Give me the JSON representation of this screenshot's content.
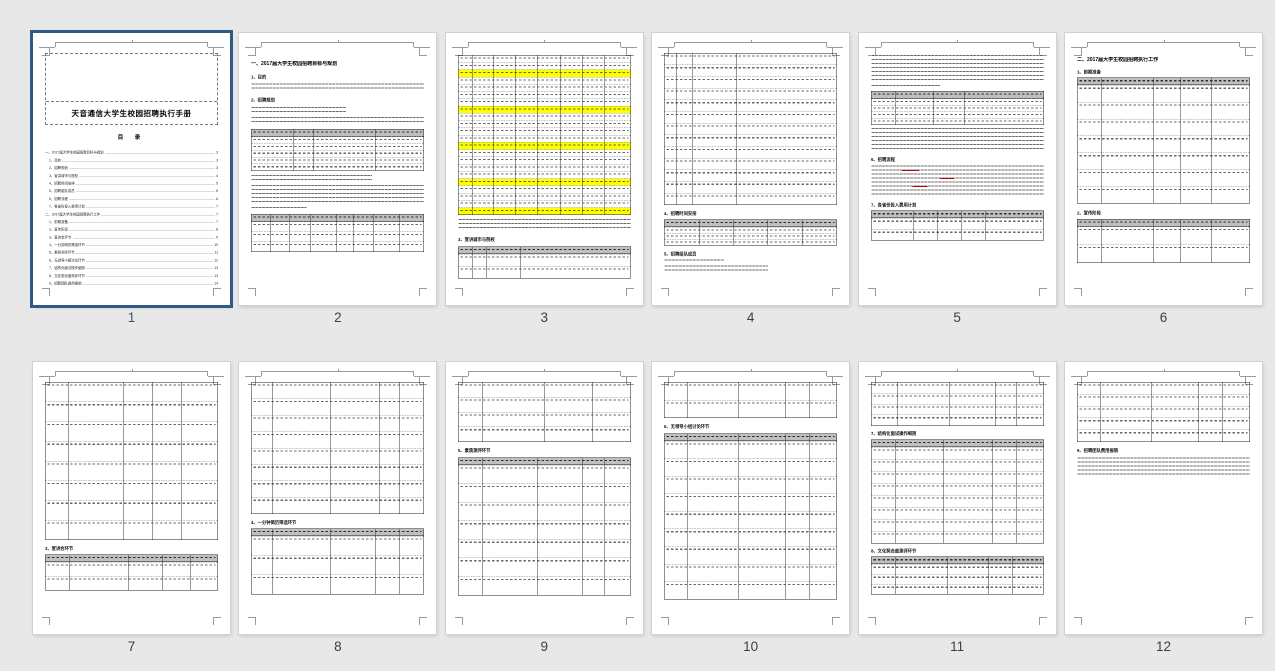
{
  "app": {
    "view": "document-thumbnail-grid",
    "background": "#e8e8e8",
    "selection_color": "#2e5a87",
    "page_number_color": "#3e3e3e",
    "selected_page_number_color": "#35587c",
    "table_header_gray": "#bfbfbf",
    "highlight_yellow": "#ffff00",
    "selected_page": "1",
    "page_count": "12"
  },
  "document": {
    "title": "天音通信大学生校园招聘执行手册",
    "toc_title": "目  录",
    "toc": [
      {
        "label": "一、2017届大学生校园招聘目标与规划",
        "page": "3",
        "indent": 0
      },
      {
        "label": "1、目的",
        "page": "3",
        "indent": 1
      },
      {
        "label": "2、招聘规划",
        "page": "3",
        "indent": 1
      },
      {
        "label": "3、宣讲城市与院校",
        "page": "4",
        "indent": 1
      },
      {
        "label": "4、招聘时间安排",
        "page": "5",
        "indent": 1
      },
      {
        "label": "5、招聘组队成员",
        "page": "5",
        "indent": 1
      },
      {
        "label": "6、招聘流程",
        "page": "6",
        "indent": 1
      },
      {
        "label": "7、各省份投入费用计划",
        "page": "7",
        "indent": 1
      },
      {
        "label": "二、2017届大学生校园招聘执行工作",
        "page": "7",
        "indent": 0
      },
      {
        "label": "1、前期准备",
        "page": "7",
        "indent": 1
      },
      {
        "label": "2、宣传阶段",
        "page": "8",
        "indent": 1
      },
      {
        "label": "3、宣讲会环节",
        "page": "9",
        "indent": 1
      },
      {
        "label": "4、一分钟简历筛选环节",
        "page": "10",
        "indent": 1
      },
      {
        "label": "5、素质测评环节",
        "page": "11",
        "indent": 1
      },
      {
        "label": "6、无领导小组讨论环节",
        "page": "12",
        "indent": 1
      },
      {
        "label": "7、结构化面试操作细则",
        "page": "13",
        "indent": 1
      },
      {
        "label": "8、文化契合度测评环节",
        "page": "13",
        "indent": 1
      },
      {
        "label": "9、招聘团队费用报销",
        "page": "14",
        "indent": 1
      }
    ]
  },
  "pages": [
    {
      "number": "1",
      "selected": true,
      "blocks": [
        {
          "t": "titlebox",
          "mt": 0,
          "h": 72
        },
        {
          "t": "toctitle",
          "mt": 8
        },
        {
          "t": "toc",
          "mt": 6
        }
      ]
    },
    {
      "number": "2",
      "selected": false,
      "blocks": [
        {
          "t": "h1",
          "text": "一、2017届大学生校园招聘目标与规划",
          "mt": 8
        },
        {
          "t": "h2",
          "text": "1、目的",
          "mt": 7
        },
        {
          "t": "para",
          "lines": 2,
          "mt": 4
        },
        {
          "t": "h2",
          "text": "2、招聘规划",
          "mt": 6
        },
        {
          "t": "para",
          "lines": 2,
          "mt": 4,
          "w": 55
        },
        {
          "t": "para",
          "lines": 2,
          "mt": 2
        },
        {
          "t": "table",
          "mt": 4,
          "h": 42,
          "cols": 4,
          "header": true,
          "rows": 5,
          "widths": [
            24,
            12,
            36,
            28
          ]
        },
        {
          "t": "para",
          "lines": 2,
          "mt": 4,
          "w": 70
        },
        {
          "t": "para",
          "lines": 5,
          "mt": 2
        },
        {
          "t": "para",
          "lines": 1,
          "mt": 2,
          "w": 32
        },
        {
          "t": "table",
          "mt": 3,
          "h": 38,
          "cols": 8,
          "header": true,
          "rows": 3,
          "widths": [
            11,
            11,
            12,
            15,
            10,
            12,
            15,
            14
          ]
        }
      ]
    },
    {
      "number": "3",
      "selected": false,
      "blocks": [
        {
          "t": "table",
          "mt": 2,
          "h": 160,
          "cols": 8,
          "rows": 22,
          "yellow": [
            2,
            7,
            12,
            17,
            21
          ],
          "widths": [
            8,
            12,
            13,
            13,
            13,
            13,
            13,
            15
          ]
        },
        {
          "t": "para",
          "lines": 3,
          "mt": 4
        },
        {
          "t": "h2",
          "text": "3、宣讲城市与院校",
          "mt": 6
        },
        {
          "t": "table",
          "mt": 4,
          "h": 32,
          "cols": 4,
          "header": true,
          "rows": 2,
          "widths": [
            8,
            8,
            20,
            64
          ]
        }
      ]
    },
    {
      "number": "4",
      "selected": false,
      "blocks": [
        {
          "t": "table",
          "mt": 0,
          "h": 152,
          "cols": 4,
          "rows": 13,
          "widths": [
            7,
            9,
            26,
            58
          ]
        },
        {
          "t": "h2",
          "text": "4、招聘时间安排",
          "mt": 6
        },
        {
          "t": "table",
          "mt": 3,
          "h": 26,
          "cols": 5,
          "header": true,
          "rows": 3,
          "widths": [
            20,
            20,
            20,
            20,
            20
          ]
        },
        {
          "t": "h2",
          "text": "5、招聘组队成员",
          "mt": 6
        },
        {
          "t": "para",
          "lines": 1,
          "mt": 3,
          "w": 35
        },
        {
          "t": "para",
          "lines": 2,
          "mt": 2,
          "w": 60
        }
      ]
    },
    {
      "number": "5",
      "selected": false,
      "blocks": [
        {
          "t": "para",
          "lines": 7,
          "mt": 2
        },
        {
          "t": "para",
          "lines": 1,
          "mt": 2,
          "w": 40
        },
        {
          "t": "table",
          "mt": 2,
          "h": 34,
          "cols": 4,
          "header": true,
          "rows": 4,
          "widths": [
            14,
            22,
            18,
            46
          ]
        },
        {
          "t": "para",
          "lines": 6,
          "mt": 3
        },
        {
          "t": "h2",
          "text": "6、招聘流程",
          "mt": 5
        },
        {
          "t": "para",
          "lines": 8,
          "mt": 3,
          "accent": true
        },
        {
          "t": "h2",
          "text": "7、各省份投入费用计划",
          "mt": 5
        },
        {
          "t": "table",
          "mt": 3,
          "h": 30,
          "cols": 5,
          "header": true,
          "rows": 2,
          "widths": [
            24,
            14,
            14,
            14,
            34
          ]
        }
      ]
    },
    {
      "number": "6",
      "selected": false,
      "blocks": [
        {
          "t": "h1",
          "text": "二、2017届大学生校园招聘执行工作",
          "mt": 4
        },
        {
          "t": "h2",
          "text": "1、前期准备",
          "mt": 6
        },
        {
          "t": "table",
          "mt": 3,
          "h": 126,
          "cols": 5,
          "header": true,
          "rows": 7,
          "widths": [
            14,
            30,
            16,
            18,
            22
          ]
        },
        {
          "t": "h2",
          "text": "2、宣传阶段",
          "mt": 7
        },
        {
          "t": "table",
          "mt": 3,
          "h": 44,
          "cols": 5,
          "header": true,
          "rows": 2,
          "widths": [
            14,
            30,
            16,
            18,
            22
          ]
        }
      ]
    },
    {
      "number": "7",
      "selected": false,
      "blocks": [
        {
          "t": "table",
          "mt": 0,
          "h": 158,
          "cols": 5,
          "rows": 8,
          "widths": [
            13,
            32,
            17,
            17,
            21
          ]
        },
        {
          "t": "h2",
          "text": "3、宣讲会环节",
          "mt": 6
        },
        {
          "t": "table",
          "mt": 3,
          "h": 36,
          "cols": 5,
          "header": true,
          "rows": 2,
          "widths": [
            14,
            34,
            20,
            16,
            16
          ]
        }
      ]
    },
    {
      "number": "8",
      "selected": false,
      "blocks": [
        {
          "t": "table",
          "mt": 0,
          "h": 132,
          "cols": 5,
          "rows": 8,
          "widths": [
            12,
            34,
            28,
            12,
            14
          ]
        },
        {
          "t": "h2",
          "text": "4、一分钟简历筛选环节",
          "mt": 6
        },
        {
          "t": "table",
          "mt": 3,
          "h": 66,
          "cols": 5,
          "header": true,
          "rows": 3,
          "widths": [
            12,
            34,
            26,
            14,
            14
          ]
        }
      ]
    },
    {
      "number": "9",
      "selected": false,
      "blocks": [
        {
          "t": "table",
          "mt": 0,
          "h": 60,
          "cols": 4,
          "rows": 4,
          "widths": [
            14,
            36,
            28,
            22
          ]
        },
        {
          "t": "h2",
          "text": "5、素质测评环节",
          "mt": 6
        },
        {
          "t": "table",
          "mt": 4,
          "h": 138,
          "cols": 5,
          "header": true,
          "rows": 7,
          "widths": [
            14,
            32,
            26,
            13,
            15
          ]
        }
      ]
    },
    {
      "number": "10",
      "selected": false,
      "blocks": [
        {
          "t": "table",
          "mt": 0,
          "h": 36,
          "cols": 5,
          "rows": 2,
          "widths": [
            13,
            30,
            27,
            14,
            16
          ]
        },
        {
          "t": "h2",
          "text": "6、无领导小组讨论环节",
          "mt": 6
        },
        {
          "t": "table",
          "mt": 4,
          "h": 166,
          "cols": 5,
          "header": true,
          "rows": 9,
          "widths": [
            13,
            30,
            27,
            14,
            16
          ]
        }
      ]
    },
    {
      "number": "11",
      "selected": false,
      "blocks": [
        {
          "t": "table",
          "mt": 0,
          "h": 44,
          "cols": 5,
          "rows": 4,
          "widths": [
            15,
            30,
            27,
            12,
            16
          ]
        },
        {
          "t": "h2",
          "text": "7、结构化面试操作细则",
          "mt": 5
        },
        {
          "t": "table",
          "mt": 3,
          "h": 104,
          "cols": 5,
          "header": true,
          "rows": 8,
          "widths": [
            14,
            28,
            28,
            14,
            16
          ]
        },
        {
          "t": "h2",
          "text": "8、文化契合度测评环节",
          "mt": 5
        },
        {
          "t": "table",
          "mt": 3,
          "h": 38,
          "cols": 5,
          "header": true,
          "rows": 3,
          "widths": [
            14,
            30,
            24,
            14,
            18
          ]
        }
      ]
    },
    {
      "number": "12",
      "selected": false,
      "blocks": [
        {
          "t": "table",
          "mt": 0,
          "h": 60,
          "cols": 5,
          "rows": 5,
          "widths": [
            13,
            30,
            27,
            14,
            16
          ]
        },
        {
          "t": "h2",
          "text": "9、招聘团队费用报销",
          "mt": 6
        },
        {
          "t": "para",
          "lines": 5,
          "mt": 4
        }
      ]
    }
  ]
}
